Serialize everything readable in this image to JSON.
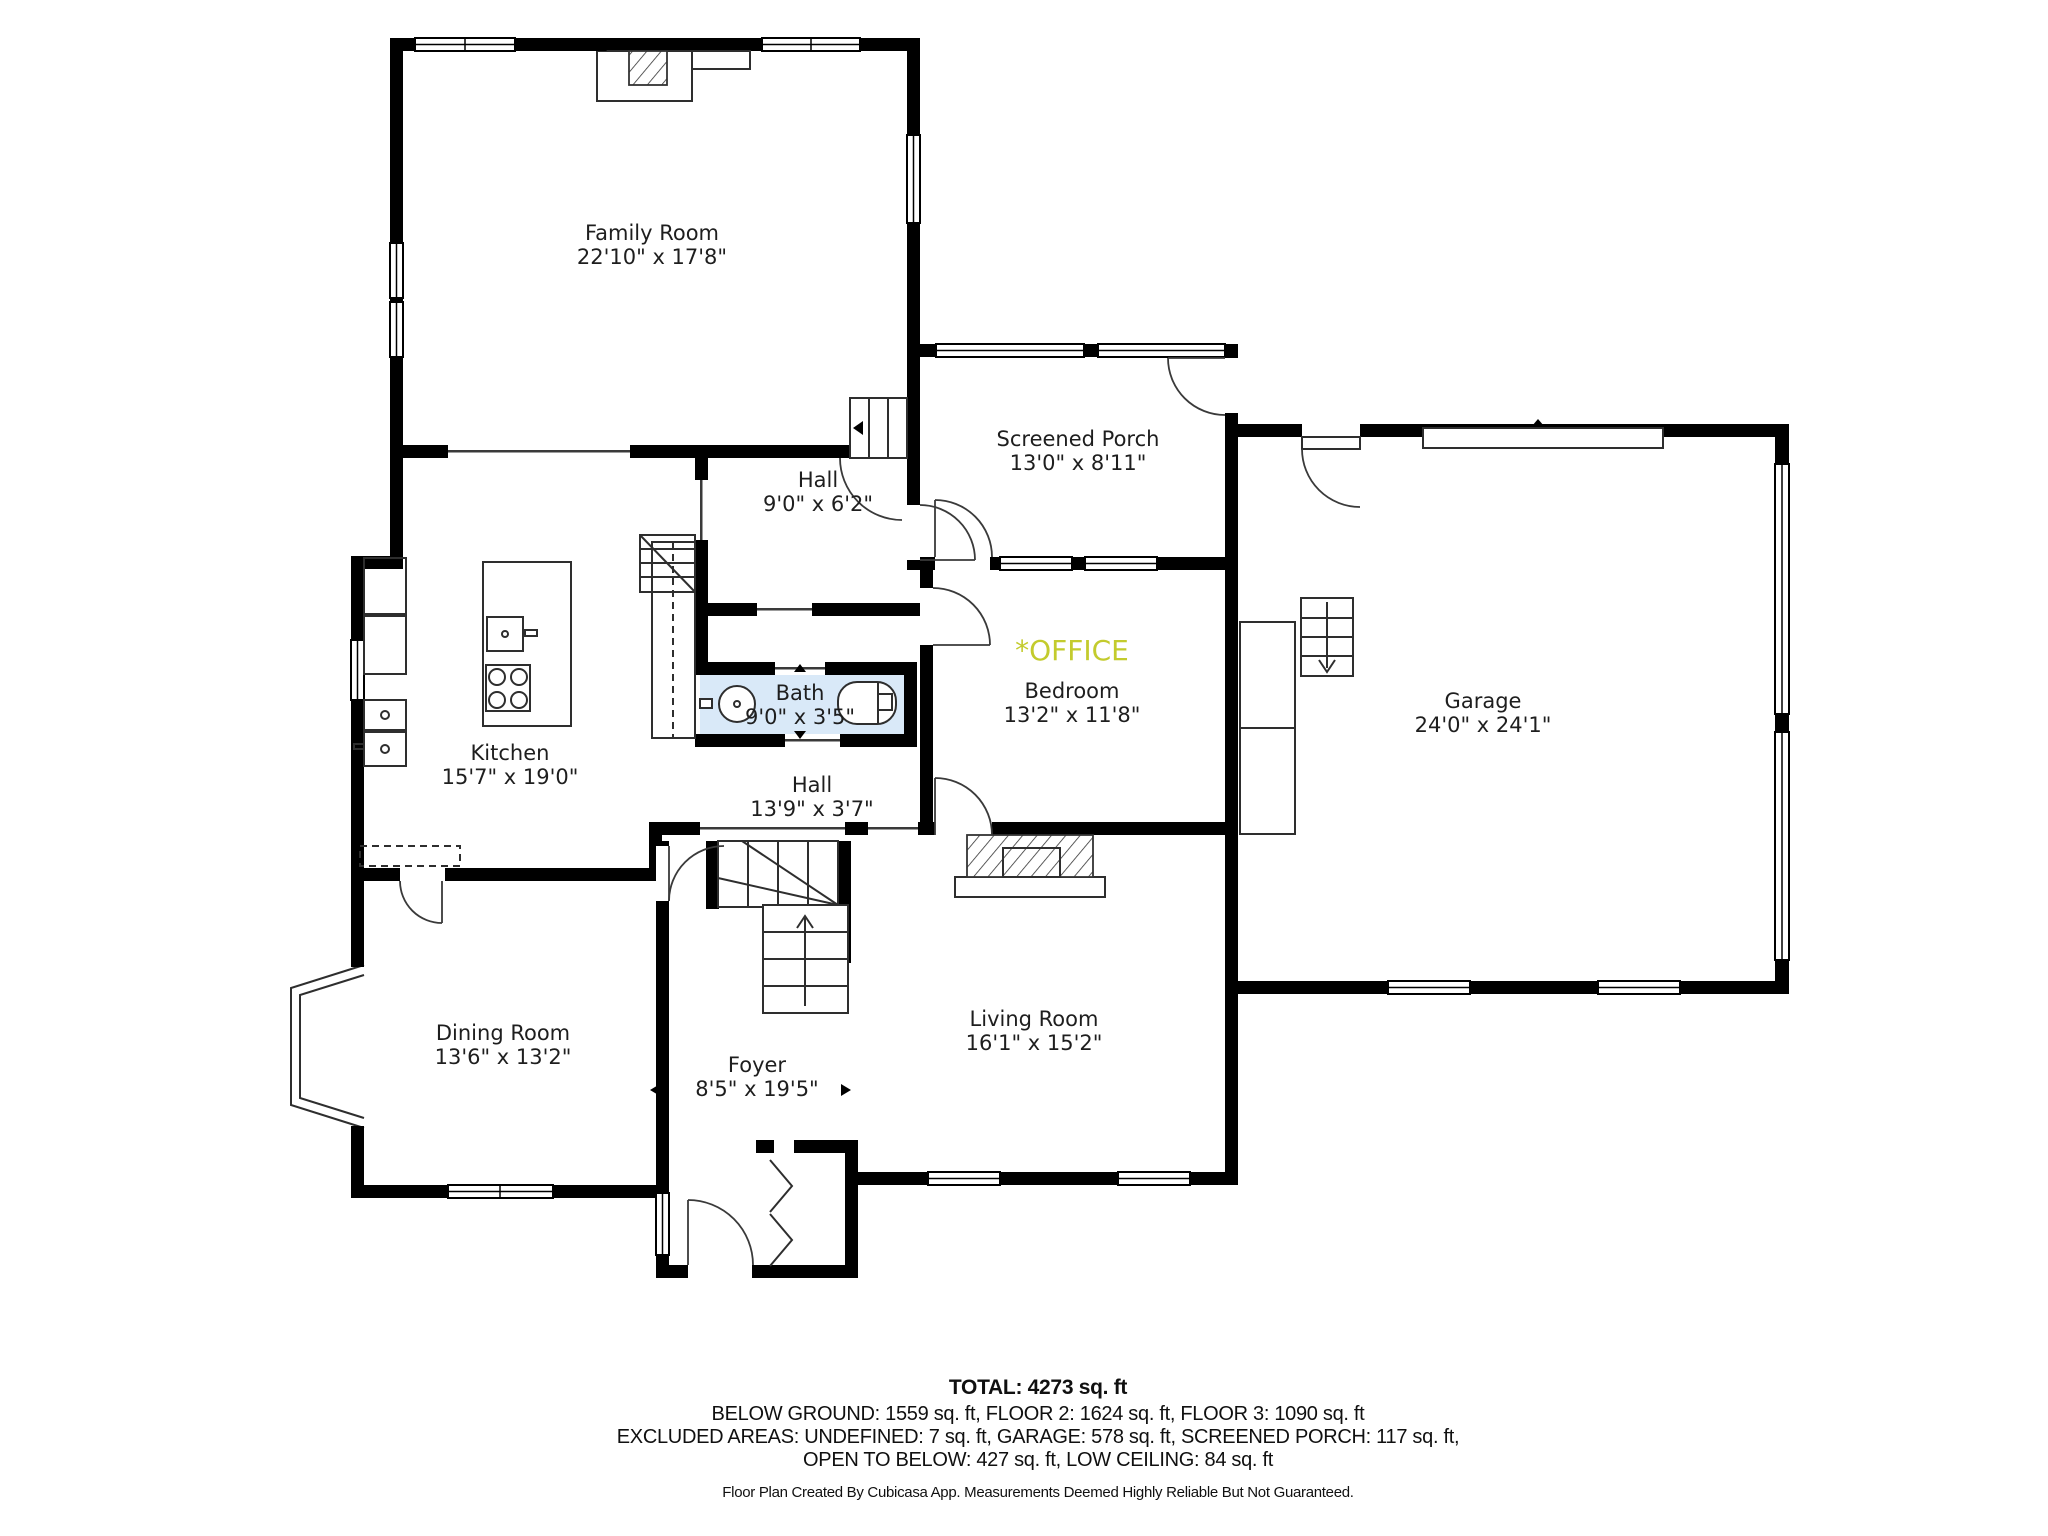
{
  "plan": {
    "rooms": [
      {
        "name": "Family Room",
        "dims": "22'10\" x 17'8\""
      },
      {
        "name": "Screened Porch",
        "dims": "13'0\" x 8'11\""
      },
      {
        "name": "Hall",
        "dims": "9'0\" x 6'2\""
      },
      {
        "name": "Kitchen",
        "dims": "15'7\" x 19'0\""
      },
      {
        "name": "Bath",
        "dims": "9'0\" x 3'5\""
      },
      {
        "name": "Bedroom",
        "dims": "13'2\" x 11'8\"",
        "tag": "*OFFICE"
      },
      {
        "name": "Garage",
        "dims": "24'0\" x 24'1\""
      },
      {
        "name": "Hall",
        "dims": "13'9\" x 3'7\""
      },
      {
        "name": "Dining Room",
        "dims": "13'6\" x 13'2\""
      },
      {
        "name": "Foyer",
        "dims": "8'5\" x 19'5\""
      },
      {
        "name": "Living Room",
        "dims": "16'1\" x 15'2\""
      }
    ],
    "colors": {
      "wall": "#000000",
      "bath_fill": "#d9e9f8",
      "office_label": "#c3cb2d",
      "label_text": "#1e1e1e"
    }
  },
  "summary": {
    "total": "TOTAL: 4273 sq. ft",
    "line1": "BELOW GROUND: 1559 sq. ft, FLOOR 2: 1624 sq. ft, FLOOR 3: 1090 sq. ft",
    "line2": "EXCLUDED AREAS: UNDEFINED: 7 sq. ft, GARAGE: 578 sq. ft, SCREENED PORCH: 117 sq. ft,",
    "line3": "OPEN TO BELOW: 427 sq. ft, LOW CEILING: 84 sq. ft",
    "footer": "Floor Plan Created By Cubicasa App. Measurements Deemed Highly Reliable But Not Guaranteed."
  }
}
